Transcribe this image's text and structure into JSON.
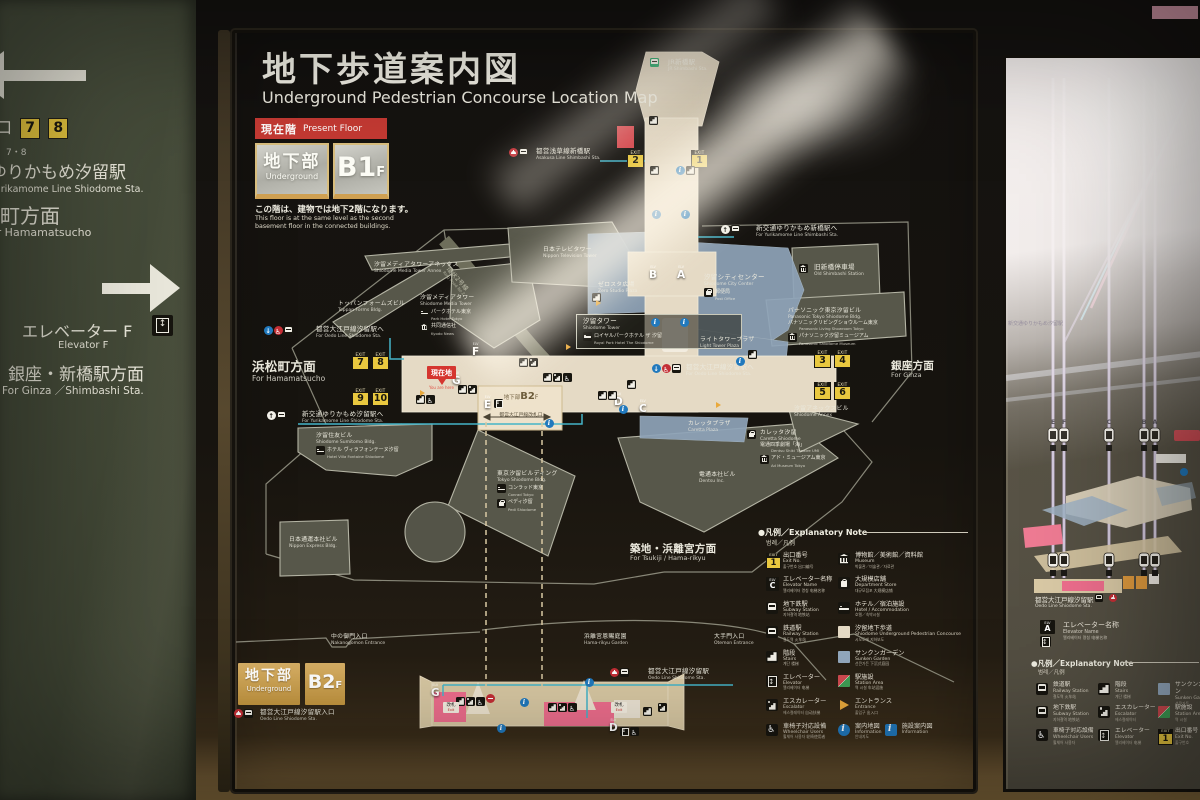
{
  "colors": {
    "exit_yellow": "#e9c83f",
    "corridor_beige": "#e5dac5",
    "sunken_blue": "#8fa4b9",
    "station_pink": "#ee6e8d",
    "present_red": "#c53a33",
    "b2f_gold": "#c2953f",
    "info_blue": "#2179bd",
    "route_cyan": "#45b4c8",
    "jr_green": "#0b9a57",
    "toei_red": "#c32e35"
  },
  "left_sign": {
    "exit_jp": "出入口",
    "exit_numbers": [
      "7",
      "8"
    ],
    "exit_en": "7・8",
    "line1_jp": "ゆりかもめ汐留駅",
    "line1_en": "Yurikamome Line Shiodome Sta.",
    "line2_jp": "浜松町方面",
    "line2_en": "For Hamamatsucho",
    "elev_jp": "エレベーター F",
    "elev_en": "Elevator F",
    "ginza_jp": "銀座・新橋駅方面",
    "ginza_en": "For Ginza ／Shimbashi Sta."
  },
  "panel": {
    "title_jp": "地下歩道案内図",
    "title_en": "Underground Pedestrian Concourse Location Map",
    "present": {
      "jp": "現在階",
      "en": "Present Floor",
      "floor_jp": "地下部",
      "floor_en": "Underground",
      "level": "B1",
      "suffix": "F",
      "note_jp": "この階は、建物では地下2階になります。",
      "note_en1": "This floor is at the same level as the second",
      "note_en2": "basement floor in the connected buildings."
    },
    "you_are_here": {
      "jp": "現在地",
      "en": "You are here"
    },
    "b2chip": {
      "floor": "地下部",
      "level": "B2",
      "suffix": "F",
      "gate_jp": "都営大江戸線改札口"
    },
    "labels": [
      {
        "jp": "JR新橋駅",
        "en": "JR Shimbashi Sta.",
        "x": 668,
        "y": 59,
        "icons": [
          "jr"
        ],
        "icon_x": 650,
        "icon_y": 58
      },
      {
        "jp": "都営浅草線新橋駅",
        "en": "Asakusa Line Shimbashi Sta.",
        "x": 536,
        "y": 148,
        "icons": [
          "toei",
          "subway"
        ],
        "icon_x": 509
      },
      {
        "jp": "新交通ゆりかもめ新橋駅へ",
        "en": "For Yurikamome Line Shimbashi Sta.",
        "x": 756,
        "y": 225,
        "icons": [
          "up",
          "train"
        ],
        "icon_x": 721
      },
      {
        "jp": "汐留シティセンター",
        "en": "Shiodome City Center",
        "x": 704,
        "y": 274,
        "subs": [
          {
            "icon": "store",
            "jp": "郵便局",
            "en": "Post Office"
          }
        ]
      },
      {
        "jp": "旧新橋停車場",
        "en": "Old Shimbashi Station",
        "x": 814,
        "y": 264,
        "icons": [
          "museum"
        ],
        "icon_x": 799
      },
      {
        "jp": "ゼロスタ広場",
        "en": "Zero Studio Plaza",
        "x": 598,
        "y": 282,
        "cls": "sm"
      },
      {
        "jp": "日本テレビタワー",
        "en": "Nippon Television Tower",
        "x": 543,
        "y": 247,
        "cls": "sm"
      },
      {
        "jp": "汐留メディアタワーアネックス",
        "en": "Shiodome Media Tower Annex",
        "x": 374,
        "y": 262,
        "cls": "sm"
      },
      {
        "jp": "トッパンフォームズビル",
        "en": "Toppan Forms Bldg.",
        "x": 338,
        "y": 301,
        "cls": "sm"
      },
      {
        "jp": "汐留メディアタワー",
        "en": "Shiodome Media Tower",
        "x": 420,
        "y": 295,
        "cls": "sm",
        "subs": [
          {
            "icon": "hotel",
            "jp": "パークホテル東京",
            "en": "Park Hotel Tokyo"
          },
          {
            "icon": "museum",
            "jp": "共同通信社",
            "en": "Kyodo News"
          }
        ]
      },
      {
        "jp": "環状2号線",
        "en": "Ring Road No.2",
        "x": 450,
        "y": 266,
        "cls": "road",
        "rot": 48
      },
      {
        "jp": "都営大江戸線汐留駅へ",
        "en": "For Oedo Line Shiodome Sta.",
        "x": 316,
        "y": 326,
        "icons": [
          "down",
          "wheelred",
          "subway"
        ],
        "icon_x": 264
      },
      {
        "jp": "浜松町方面",
        "en": "For Hamamatsucho",
        "x": 252,
        "y": 360,
        "cls": "lg"
      },
      {
        "jp": "汐留タワー",
        "en": "Shiodome Tower",
        "x": 576,
        "y": 314,
        "cls": "boxed",
        "subs": [
          {
            "icon": "hotel",
            "jp": "ロイヤルパークホテル ザ 汐留",
            "en": "Royal Park Hotel The Shiodome"
          }
        ]
      },
      {
        "jp": "ライトタワープラザ",
        "en": "Light Tower Plaza",
        "x": 700,
        "y": 337,
        "cls": "sm"
      },
      {
        "jp": "パナソニック東京汐留ビル",
        "en": "Panasonic Tokyo Shiodome Bldg.",
        "x": 788,
        "y": 308,
        "cls": "sm",
        "subs": [
          {
            "jp": "パナソニックリビングショウルーム東京",
            "en": "Panasonic Living Showroom Tokyo"
          },
          {
            "icon": "museum",
            "jp": "パナソニック汐留ミュージアム",
            "en": "Panasonic Shiodome Museum"
          }
        ]
      },
      {
        "jp": "都営大江戸線汐留駅へ",
        "en": "For Oedo Line Shiodome Sta.",
        "x": 686,
        "y": 364,
        "icons": [
          "down",
          "wheelred",
          "subway"
        ],
        "icon_x": 652
      },
      {
        "jp": "新交通ゆりかもめ汐留駅へ",
        "en": "For Yurikamome Line Shiodome Sta.",
        "x": 302,
        "y": 411,
        "icons": [
          "up",
          "train"
        ],
        "icon_x": 267
      },
      {
        "jp": "汐留住友ビル",
        "en": "Shiodome Sumitomo Bldg.",
        "x": 316,
        "y": 433,
        "cls": "sm",
        "subs": [
          {
            "icon": "hotel",
            "jp": "ホテル ヴィラフォンテーヌ汐留",
            "en": "Hotel Villa Fontaine Shiodome"
          }
        ]
      },
      {
        "jp": "日本通運本社ビル",
        "en": "Nippon Express Bldg.",
        "x": 289,
        "y": 537,
        "cls": "sm"
      },
      {
        "jp": "東京汐留ビルディング",
        "en": "Tokyo Shiodome Bldg.",
        "x": 497,
        "y": 471,
        "cls": "sm",
        "subs": [
          {
            "icon": "hotel",
            "jp": "コンラッド東京",
            "en": "Conrad Tokyo"
          },
          {
            "icon": "store",
            "jp": "ペディ汐留",
            "en": "Pedi Shiodome"
          }
        ]
      },
      {
        "jp": "カレッタプラザ",
        "en": "Caretta Plaza",
        "x": 688,
        "y": 421,
        "cls": "sm"
      },
      {
        "jp": "カレッタ汐留",
        "en": "Caretta Shiodome",
        "x": 760,
        "y": 430,
        "cls": "sm",
        "icons": [
          "store"
        ],
        "icon_x": 747,
        "subs": [
          {
            "jp": "電通四季劇場「海」",
            "en": "Dentsu Shiki Theatre UMI"
          },
          {
            "icon": "museum",
            "jp": "アド・ミュージアム東京",
            "en": "Ad Museum Tokyo"
          }
        ]
      },
      {
        "jp": "汐留アネックスビル",
        "en": "Shiodome Annex",
        "x": 794,
        "y": 406,
        "cls": "sm"
      },
      {
        "jp": "電通本社ビル",
        "en": "Dentsu Inc.",
        "x": 699,
        "y": 472,
        "cls": "sm"
      },
      {
        "jp": "築地・浜離宮方面",
        "en": "For Tsukiji / Hama-rikyu",
        "x": 630,
        "y": 543,
        "cls": "lg2"
      },
      {
        "jp": "銀座方面",
        "en": "For Ginza",
        "x": 891,
        "y": 360,
        "cls": "lg2"
      },
      {
        "jp": "中の御門入口",
        "en": "Nakanogomon Entrance",
        "x": 331,
        "y": 634,
        "cls": "sm"
      },
      {
        "jp": "浜離宮恩賜庭園",
        "en": "Hama-rikyu Garden",
        "x": 584,
        "y": 634,
        "cls": "sm"
      },
      {
        "jp": "大手門入口",
        "en": "Otemon Entrance",
        "x": 714,
        "y": 634,
        "cls": "sm"
      },
      {
        "jp": "都営大江戸線汐留駅",
        "en": "Oedo Line Shiodome Sta.",
        "x": 648,
        "y": 668,
        "icons": [
          "toei",
          "subway"
        ],
        "icon_x": 610
      },
      {
        "jp": "都営大江戸線汐留駅入口",
        "en": "Oedo Line Shiodome Sta.",
        "x": 260,
        "y": 709,
        "icons": [
          "toei",
          "subway"
        ],
        "icon_x": 234
      }
    ],
    "exits": [
      {
        "n": "2",
        "x": 627,
        "y": 150
      },
      {
        "n": "1",
        "x": 691,
        "y": 150
      },
      {
        "n": "7",
        "x": 352,
        "y": 352
      },
      {
        "n": "8",
        "x": 372,
        "y": 352
      },
      {
        "n": "9",
        "x": 352,
        "y": 388
      },
      {
        "n": "10",
        "x": 372,
        "y": 388
      },
      {
        "n": "3",
        "x": 814,
        "y": 350
      },
      {
        "n": "4",
        "x": 834,
        "y": 350
      },
      {
        "n": "5",
        "x": 814,
        "y": 382
      },
      {
        "n": "6",
        "x": 834,
        "y": 382
      }
    ],
    "elevators": [
      {
        "l": "B",
        "x": 649,
        "y": 266
      },
      {
        "l": "A",
        "x": 677,
        "y": 266
      },
      {
        "l": "G",
        "x": 452,
        "y": 372
      },
      {
        "l": "F",
        "x": 472,
        "y": 343
      },
      {
        "l": "E",
        "x": 484,
        "y": 396
      },
      {
        "l": "D",
        "x": 614,
        "y": 393
      },
      {
        "l": "C",
        "x": 639,
        "y": 400
      },
      {
        "l": "G",
        "x": 431,
        "y": 684
      },
      {
        "l": "D",
        "x": 609,
        "y": 719
      }
    ],
    "icons": [
      {
        "t": "stairs",
        "x": 649,
        "y": 116
      },
      {
        "t": "stairs",
        "x": 650,
        "y": 166
      },
      {
        "t": "info",
        "x": 676,
        "y": 166
      },
      {
        "t": "stairs",
        "x": 686,
        "y": 166
      },
      {
        "t": "info",
        "x": 652,
        "y": 210
      },
      {
        "t": "info",
        "x": 681,
        "y": 210
      },
      {
        "t": "stairs",
        "x": 592,
        "y": 293
      },
      {
        "t": "info",
        "x": 651,
        "y": 318
      },
      {
        "t": "info",
        "x": 680,
        "y": 318
      },
      {
        "t": "stairs",
        "x": 748,
        "y": 350
      },
      {
        "t": "stairs",
        "x": 519,
        "y": 358
      },
      {
        "t": "esc",
        "x": 529,
        "y": 358
      },
      {
        "t": "stairs",
        "x": 543,
        "y": 373
      },
      {
        "t": "esc",
        "x": 553,
        "y": 373
      },
      {
        "t": "wheel",
        "x": 563,
        "y": 373
      },
      {
        "t": "stairs",
        "x": 458,
        "y": 385
      },
      {
        "t": "esc",
        "x": 468,
        "y": 385
      },
      {
        "t": "stairs",
        "x": 416,
        "y": 395
      },
      {
        "t": "wheel",
        "x": 426,
        "y": 395
      },
      {
        "t": "stairs",
        "x": 598,
        "y": 391
      },
      {
        "t": "stairs",
        "x": 608,
        "y": 391
      },
      {
        "t": "elev",
        "x": 494,
        "y": 399
      },
      {
        "t": "info",
        "x": 619,
        "y": 405
      },
      {
        "t": "info",
        "x": 736,
        "y": 357
      },
      {
        "t": "stairs",
        "x": 627,
        "y": 380
      },
      {
        "t": "info",
        "x": 545,
        "y": 419
      },
      {
        "t": "ent",
        "x": 596,
        "y": 300
      },
      {
        "t": "ent",
        "x": 566,
        "y": 344
      },
      {
        "t": "ent",
        "x": 420,
        "y": 390
      },
      {
        "t": "ent",
        "x": 716,
        "y": 402
      },
      {
        "t": "stairs",
        "x": 456,
        "y": 697
      },
      {
        "t": "esc",
        "x": 466,
        "y": 697
      },
      {
        "t": "wheel",
        "x": 476,
        "y": 697
      },
      {
        "t": "redminus",
        "x": 486,
        "y": 694
      },
      {
        "t": "info",
        "x": 520,
        "y": 698
      },
      {
        "t": "stairs",
        "x": 548,
        "y": 703
      },
      {
        "t": "esc",
        "x": 558,
        "y": 703
      },
      {
        "t": "wheel",
        "x": 568,
        "y": 703
      },
      {
        "t": "info",
        "x": 497,
        "y": 724
      },
      {
        "t": "stairs",
        "x": 643,
        "y": 707
      },
      {
        "t": "esc",
        "x": 658,
        "y": 703
      },
      {
        "t": "elev",
        "x": 620,
        "y": 727
      },
      {
        "t": "wheel",
        "x": 630,
        "y": 727
      },
      {
        "t": "info",
        "x": 585,
        "y": 678
      },
      {
        "t": "kaisatsu",
        "x": 443,
        "y": 702
      },
      {
        "t": "kaisatsu",
        "x": 611,
        "y": 702
      }
    ],
    "legend": {
      "header_jp": "●凡例／Explanatory Note",
      "header_sub": "범례／凡例",
      "left": [
        {
          "icon": "exit1",
          "jp": "出口番号",
          "en": "Exit No.",
          "sub": "출구번호 出口编号"
        },
        {
          "icon": "elvc",
          "jp": "エレベーター名称",
          "en": "Elevator Name",
          "sub": "엘리베이터 명칭 电梯名称"
        },
        {
          "icon": "subway",
          "jp": "地下鉄駅",
          "en": "Subway Station",
          "sub": "지하철역 地铁站"
        },
        {
          "icon": "train",
          "jp": "鉄道駅",
          "en": "Railway Station",
          "sub": "철도역 火车站"
        },
        {
          "icon": "stairs",
          "jp": "階段",
          "en": "Stairs",
          "sub": "계단 楼梯"
        },
        {
          "icon": "elev",
          "jp": "エレベーター",
          "en": "Elevator",
          "sub": "엘리베이터 电梯"
        },
        {
          "icon": "esc",
          "jp": "エスカレーター",
          "en": "Escalator",
          "sub": "에스컬레이터 自动扶梯"
        },
        {
          "icon": "wheel",
          "jp": "車椅子対応設備",
          "en": "Wheelchair Users",
          "sub": "휠체어 사용자 轮椅使用者"
        }
      ],
      "right": [
        {
          "icon": "museum",
          "jp": "博物館／美術館／資料館",
          "en": "Museum",
          "sub": "박물관／미술관／자료관"
        },
        {
          "icon": "store",
          "jp": "大規模店舗",
          "en": "Department Store",
          "sub": "대규모점포 大规模店铺"
        },
        {
          "icon": "hotel",
          "jp": "ホテル／宿泊施設",
          "en": "Hotel / Accommodation",
          "sub": "호텔／숙박시설"
        },
        {
          "icon": "sq-walk",
          "jp": "汐留地下歩道",
          "en": "Shiodome Underground Pedestrian Concourse",
          "sub": "시오도메 지하보도"
        },
        {
          "icon": "sq-garden",
          "jp": "サンクンガーデン",
          "en": "Sunken Garden",
          "sub": "선큰가든 下沉式庭园"
        },
        {
          "icon": "sq-station",
          "jp": "駅施設",
          "en": "Station Area",
          "sub": "역 시설 车站设施"
        },
        {
          "icon": "tri-ent",
          "jp": "エントランス",
          "en": "Entrance",
          "sub": "출입구 出入口"
        },
        {
          "icon": "info",
          "jp": "案内地図",
          "en": "Information",
          "sub": "안내지도",
          "icon2": "infosq",
          "jp2": "施設案内図",
          "en2": "Information"
        }
      ]
    },
    "b2f": {
      "floor_jp": "地下部",
      "floor_en": "Underground",
      "level": "B2",
      "suffix": "F",
      "kaisatsu_jp": "改札",
      "kaisatsu_en": "Exit"
    }
  },
  "right_panel": {
    "faint1": "新交通ゆりかもめ汐留駅",
    "station_jp": "都営大江戸線汐留駅",
    "station_en": "Oedo Line Shiodome Sta.",
    "elv_label": "ELV",
    "elv_letter": "A",
    "elv_name_jp": "エレベーター名称",
    "elv_name_en": "Elevator Name",
    "elv_name_sub": "엘리베이터 명칭 电梯名称",
    "header_jp": "●凡例／Explanatory Note",
    "header_sub": "범례／凡例",
    "shaft_letters": [
      "E",
      "F",
      "C",
      "B",
      "A"
    ],
    "legend": [
      [
        {
          "icon": "train",
          "jp": "鉄道駅",
          "en": "Railway Station",
          "sub": "철도역 火车站"
        },
        {
          "icon": "subway",
          "jp": "地下鉄駅",
          "en": "Subway Station",
          "sub": "지하철역 地铁站"
        },
        {
          "icon": "wheel",
          "jp": "車椅子対応設備",
          "en": "Wheelchair Users",
          "sub": "휠체어 사용자"
        }
      ],
      [
        {
          "icon": "stairs",
          "jp": "階段",
          "en": "Stairs",
          "sub": "계단 楼梯"
        },
        {
          "icon": "esc",
          "jp": "エスカレーター",
          "en": "Escalator",
          "sub": "에스컬레이터"
        },
        {
          "icon": "elev",
          "jp": "エレベーター",
          "en": "Elevator",
          "sub": "엘리베이터 电梯"
        }
      ],
      [
        {
          "icon": "sq-garden",
          "jp": "サンクンガーデン",
          "en": "Sunken Garden",
          "sub": "선큰가든"
        },
        {
          "icon": "sq-station",
          "jp": "駅施設",
          "en": "Station Area",
          "sub": "역 시설"
        },
        {
          "icon": "exit1",
          "jp": "出口番号",
          "en": "Exit No.",
          "sub": "출구번호"
        }
      ]
    ]
  }
}
